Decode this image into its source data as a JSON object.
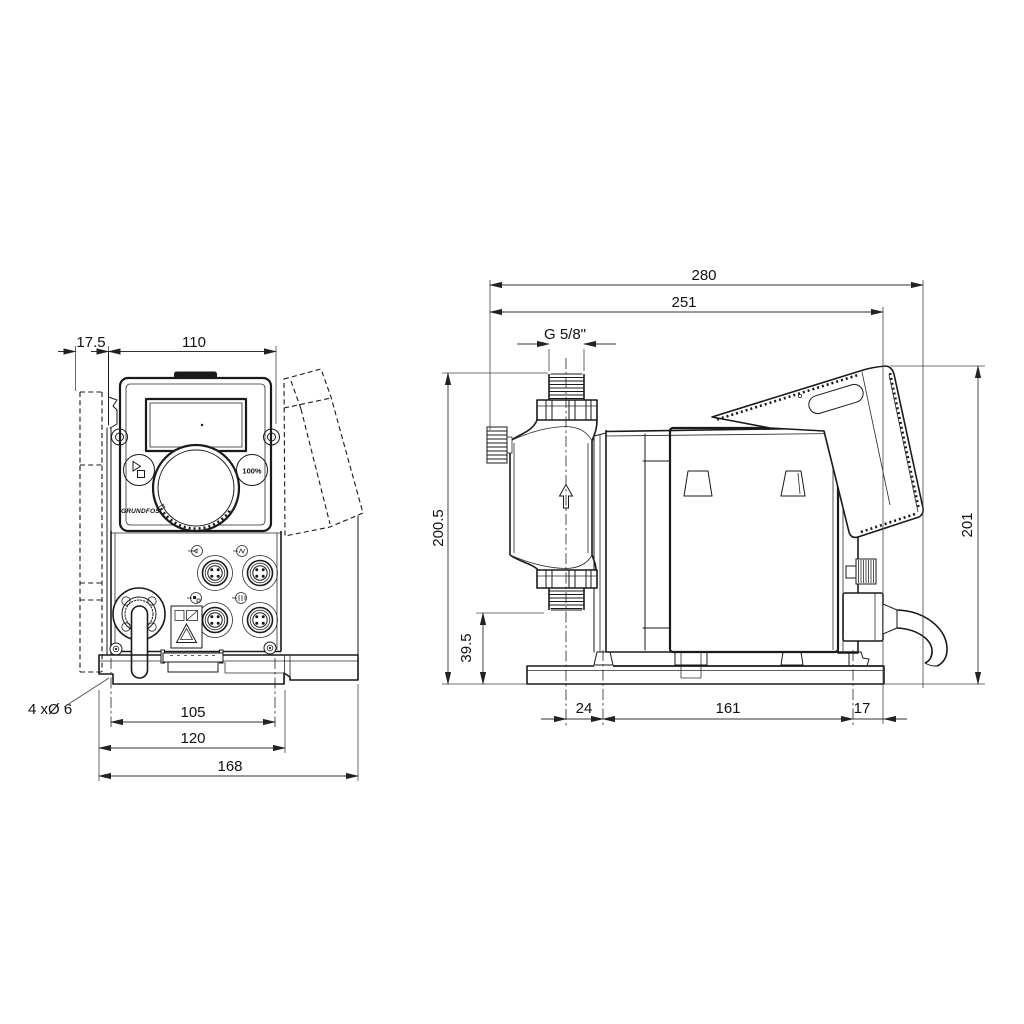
{
  "title": "Dosing pump dimensional drawing",
  "colors": {
    "ink": "#1a1a1a",
    "paper": "#ffffff"
  },
  "front_view": {
    "dim_offset": "17.5",
    "dim_width": "110",
    "dim_slot_spacing": "105",
    "dim_plate_width": "120",
    "dim_overall_width": "168",
    "hole_note": "4 xØ 6",
    "button_100_label": "100%",
    "logo_text": "GRUNDFOS"
  },
  "side_view": {
    "dim_overall_depth": "280",
    "dim_depth_to_cable_plane": "251",
    "thread_label": "G 5/8\"",
    "dim_height_overall": "200.5",
    "dim_valve_to_base": "39.5",
    "dim_base_front": "24",
    "dim_base_slot_spacing": "161",
    "dim_base_rear": "17",
    "dim_height_rear": "201"
  }
}
